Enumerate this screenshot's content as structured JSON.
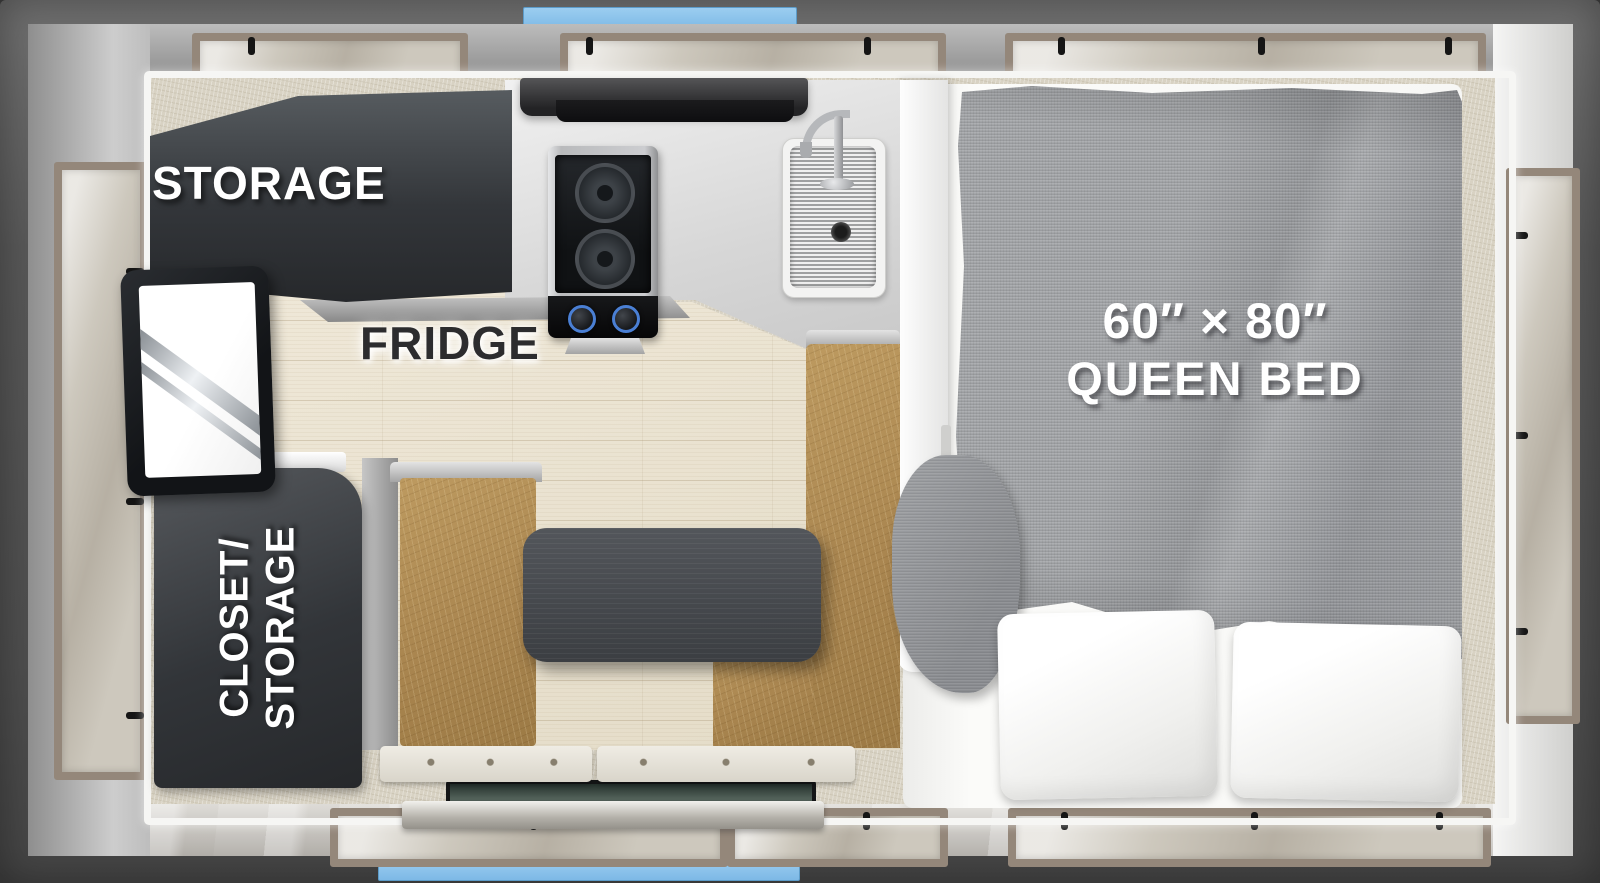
{
  "diagram": {
    "title": "truck-camper-floorplan-top-view",
    "labels": {
      "storage": "STORAGE",
      "fridge": "FRIDGE",
      "closet_line1": "CLOSET/",
      "closet_line2": "STORAGE",
      "bed_size": "60″ × 80″",
      "bed_type": "QUEEN BED"
    },
    "colors": {
      "outer_frame": "#585858",
      "accent_blue": "#7db9e6",
      "wall_gray": "#a9a9a9",
      "window_frame_taupe": "#94877a",
      "carpet_beige": "#d8d2c3",
      "wood_floor": "#e9e2d2",
      "cabinet_dark": "#33363a",
      "counter_light": "#e4e4e4",
      "bench_tan": "#aa8650",
      "table_dark": "#46494d",
      "blanket_gray": "#9b9da0",
      "pillow_white": "#f7f7f5",
      "knob_blue": "#4a7fd4"
    },
    "fixtures": [
      "storage-cabinet",
      "fridge",
      "closet-storage-cabinet",
      "range-hood",
      "two-burner-stove",
      "kitchen-sink",
      "faucet",
      "kitchen-counter",
      "dinette-table",
      "dinette-bench-left",
      "dinette-bench-right",
      "seat-cushions",
      "entry-step",
      "queen-bed",
      "bed-blanket",
      "pillows",
      "windows",
      "wood-floor",
      "carpet"
    ]
  }
}
